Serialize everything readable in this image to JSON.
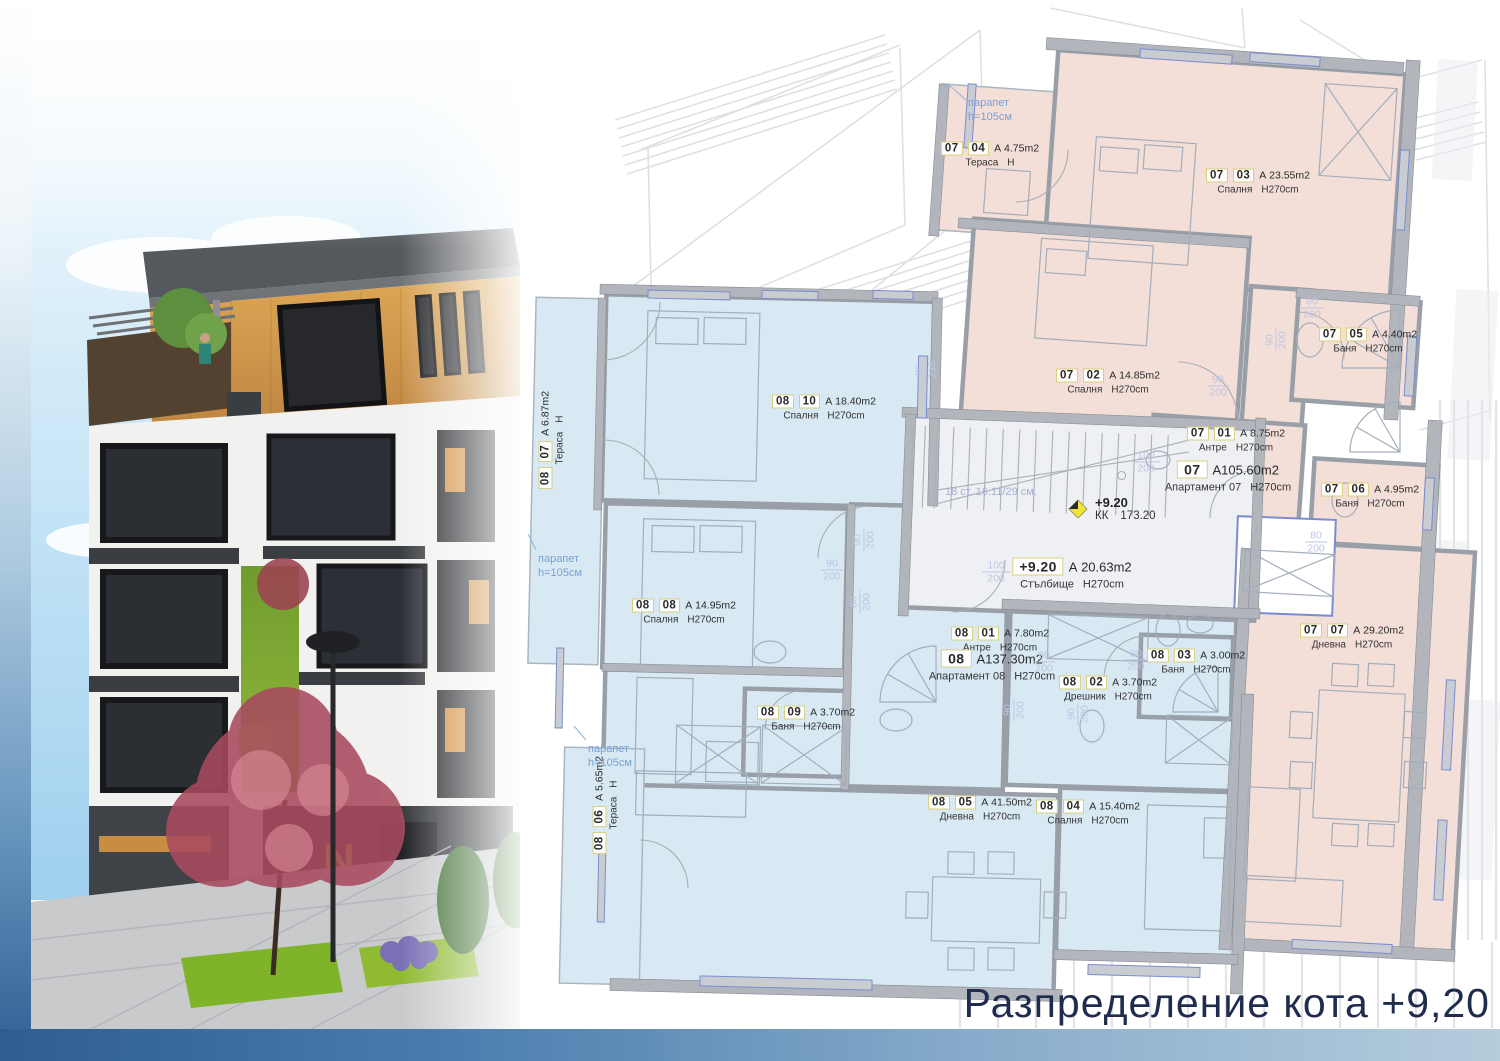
{
  "title": {
    "text": "Разпределение кота +9,20"
  },
  "palette": {
    "apartment_07_fill": "#f3ded8",
    "apartment_08_fill": "#d9e9f3",
    "stairwell_fill": "#eef0f3",
    "wall": "#999fa7",
    "dimension_text": "#bcc5e4",
    "annotation_blue": "#74a2d8",
    "title_navy": "#1f2c4e",
    "marker_yellow": "#f2e23c"
  },
  "plan": {
    "rooms": [
      {
        "c1": "07",
        "c2": "04",
        "area": "А  4.75m2",
        "name": "Тераса",
        "height": "Н"
      },
      {
        "c1": "07",
        "c2": "03",
        "area": "А  23.55m2",
        "name": "Спалня",
        "height": "H270cm"
      },
      {
        "c1": "07",
        "c2": "02",
        "area": "А  14.85m2",
        "name": "Спалня",
        "height": "H270cm"
      },
      {
        "c1": "07",
        "c2": "05",
        "area": "А  4.40m2",
        "name": "Баня",
        "height": "H270cm"
      },
      {
        "c1": "07",
        "c2": "01",
        "area": "А  8.75m2",
        "name": "Антре",
        "height": "H270cm"
      },
      {
        "c1": "07",
        "c2": "06",
        "area": "А  4.95m2",
        "name": "Баня",
        "height": "H270cm"
      },
      {
        "c1": "07",
        "c2": "07",
        "area": "А  29.20m2",
        "name": "Дневна",
        "height": "H270cm"
      },
      {
        "c1": "08",
        "c2": "10",
        "area": "А  18.40m2",
        "name": "Спалня",
        "height": "H270cm"
      },
      {
        "c1": "08",
        "c2": "08",
        "area": "А  14.95m2",
        "name": "Спалня",
        "height": "H270cm"
      },
      {
        "c1": "08",
        "c2": "07",
        "area": "А  6.87m2",
        "name": "Тераса",
        "height": "Н"
      },
      {
        "c1": "08",
        "c2": "01",
        "area": "А  7.80m2",
        "name": "Антре",
        "height": "H270cm"
      },
      {
        "c1": "08",
        "c2": "02",
        "area": "А  3.70m2",
        "name": "Дрешник",
        "height": "H270cm"
      },
      {
        "c1": "08",
        "c2": "03",
        "area": "А  3.00m2",
        "name": "Баня",
        "height": "H270cm"
      },
      {
        "c1": "08",
        "c2": "09",
        "area": "А  3.70m2",
        "name": "Баня",
        "height": "H270cm"
      },
      {
        "c1": "08",
        "c2": "05",
        "area": "А  41.50m2",
        "name": "Дневна",
        "height": "H270cm"
      },
      {
        "c1": "08",
        "c2": "04",
        "area": "А  15.40m2",
        "name": "Спалня",
        "height": "H270cm"
      },
      {
        "c1": "08",
        "c2": "06",
        "area": "А  5.65m2",
        "name": "Тераса",
        "height": "Н"
      }
    ],
    "apartments": [
      {
        "code": "07",
        "area": "А105.60m2",
        "name": "Апартамент 07",
        "height": "H270cm"
      },
      {
        "code": "08",
        "area": "А137.30m2",
        "name": "Апартамент 08",
        "height": "H270cm"
      },
      {
        "code": "+9.20",
        "area": "А  20.63m2",
        "name": "Стълбище",
        "height": "H270cm"
      }
    ],
    "elevation_marker": {
      "level": "+9.20",
      "kk": "КК",
      "kk_value": "173.20"
    },
    "stairs_note": "18 ст. 16.11/29 см.",
    "parapet_line1": "парапет",
    "parapet_line2": "h=105см",
    "dims": [
      {
        "a": "80",
        "b": "200"
      },
      {
        "a": "90",
        "b": "200"
      },
      {
        "a": "90",
        "b": "200"
      },
      {
        "a": "100",
        "b": "200"
      },
      {
        "a": "100",
        "b": "200"
      },
      {
        "a": "70",
        "b": "235"
      },
      {
        "a": "80",
        "b": "200"
      },
      {
        "a": "90",
        "b": "200"
      },
      {
        "a": "80",
        "b": "200"
      },
      {
        "a": "90",
        "b": "200"
      },
      {
        "a": "90",
        "b": "200"
      },
      {
        "a": "90",
        "b": "200"
      },
      {
        "a": "80",
        "b": "200"
      },
      {
        "a": "90",
        "b": "200"
      }
    ]
  },
  "render": {
    "shop_sign": "N"
  }
}
